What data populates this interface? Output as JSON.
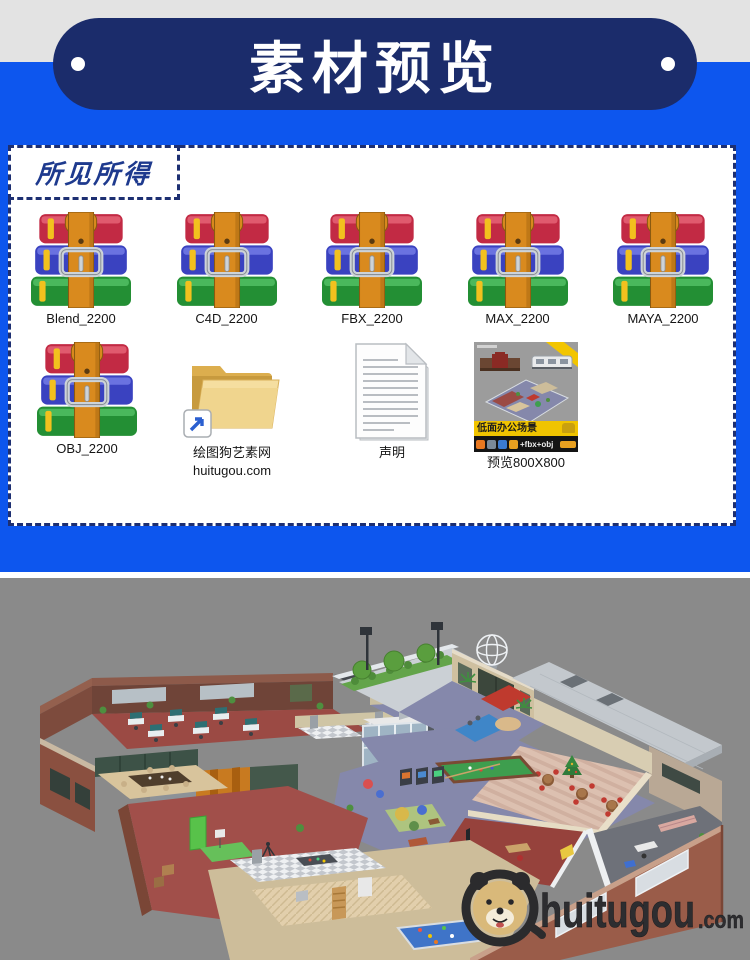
{
  "header": {
    "title": "素材预览"
  },
  "panel": {
    "tagline": "所见所得"
  },
  "files": {
    "row1": [
      {
        "label": "Blend_2200"
      },
      {
        "label": "C4D_2200"
      },
      {
        "label": "FBX_2200"
      },
      {
        "label": "MAX_2200"
      },
      {
        "label": "MAYA_2200"
      }
    ],
    "obj": {
      "label": "OBJ_2200"
    },
    "folder": {
      "line1": "绘图狗艺素网",
      "line2": "huitugou.com"
    },
    "doc": {
      "label": "声明"
    },
    "preview": {
      "label": "预览800X800",
      "banner": "低面办公场景",
      "formats": "+fbx+obj"
    }
  },
  "render": {
    "watermark_name": "huitugou",
    "watermark_tld": ".com"
  },
  "colors": {
    "accent_blue": "#0d56ee",
    "navy_pill": "#1b2c6b",
    "photo_bg": "#8a8a8a",
    "banner_yellow": "#f0c400"
  }
}
